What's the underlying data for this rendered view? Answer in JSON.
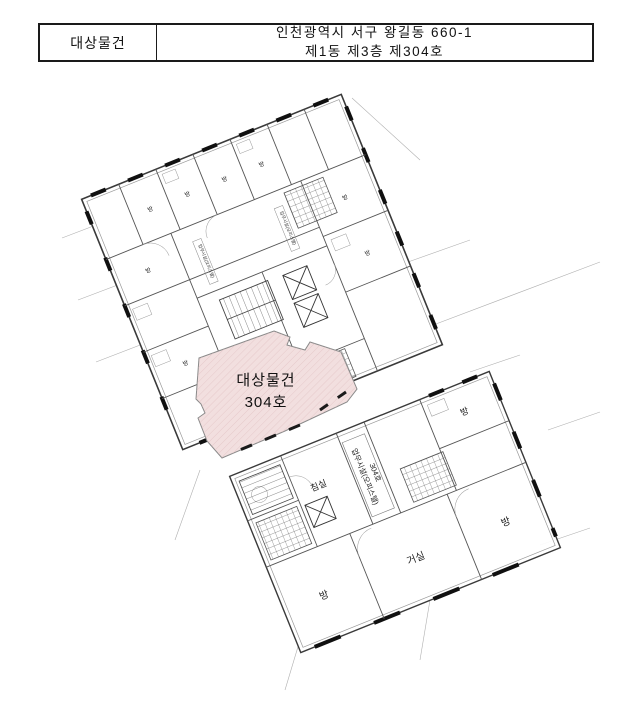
{
  "header": {
    "label": "대상물건",
    "address_line1": "인천광역시 서구 왕길동 660-1",
    "address_line2": "제1동 제3층 제304호"
  },
  "subject_unit": {
    "name": "대상물건",
    "unit": "304호",
    "fill": "#f2dfdf",
    "hatch_color": "#ddbabc"
  },
  "upper_plan": {
    "rooms": [
      "방",
      "방",
      "방",
      "방",
      "방",
      "방",
      "방",
      "방"
    ],
    "strip_label_1": "업무시설(오피스텔)",
    "strip_label_2": "업무시설(오피스텔)"
  },
  "lower_plan": {
    "bedroom": "침실",
    "unit_line1": "업무시설(오피스텔)",
    "unit_line2": "304호",
    "room_left": "방",
    "living": "거실",
    "room_right": "방",
    "room_top_right": "방"
  }
}
